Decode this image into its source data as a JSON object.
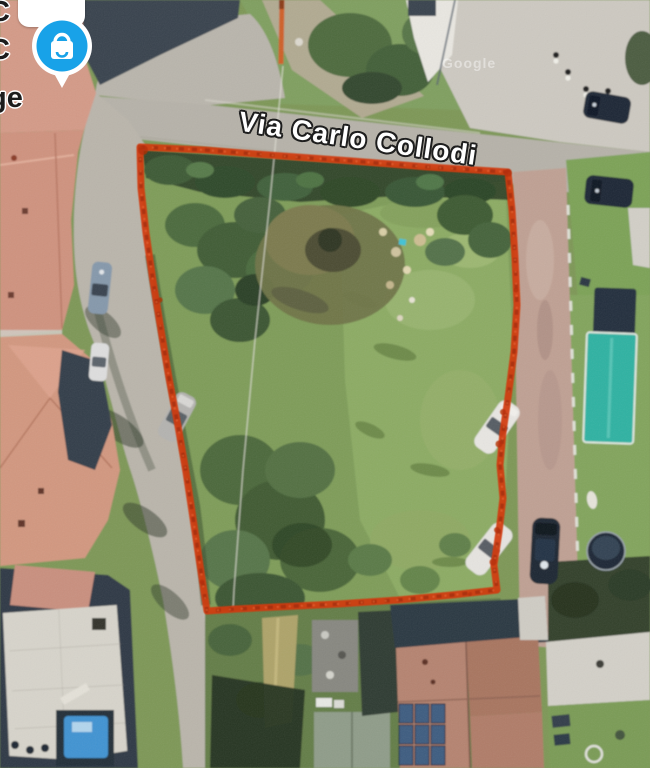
{
  "map": {
    "street_label": "Via Carlo Collodi",
    "watermark": "Google",
    "edge_labels": [
      "C",
      "C",
      "ge"
    ]
  },
  "marker": {
    "name": "shopping-bag-pin"
  },
  "colors": {
    "boundary_red": "#d13a0e",
    "pin_blue": "#18a2e8",
    "pin_border": "#ffffff",
    "street_label_fill": "#ffffff",
    "street_label_outline": "#1e1e1e"
  }
}
